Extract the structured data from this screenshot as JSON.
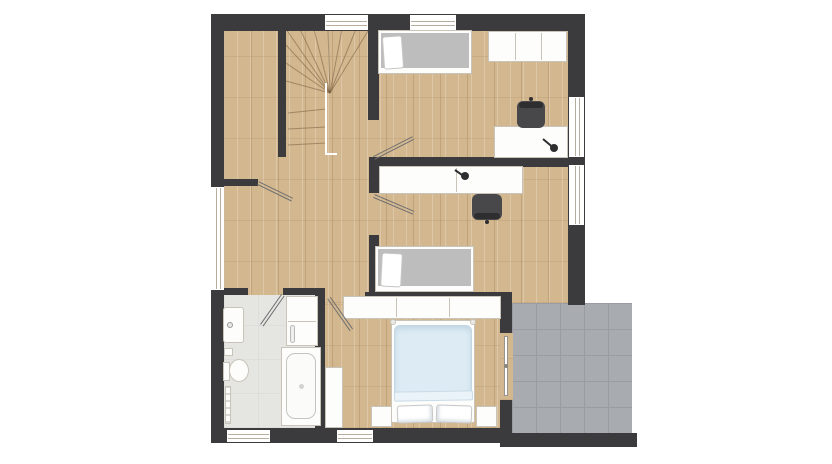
{
  "plan": {
    "kind": "residential-floor-plan",
    "visible_text": "",
    "rooms": [
      {
        "id": "closet",
        "name": "closet",
        "floor": "wood",
        "furniture": []
      },
      {
        "id": "stairwell",
        "name": "stairwell",
        "floor": "wood",
        "furniture": [
          "winder-stairs",
          "railing"
        ]
      },
      {
        "id": "hallway",
        "name": "hallway",
        "floor": "wood",
        "furniture": []
      },
      {
        "id": "bedroom-1",
        "name": "bedroom-top-right",
        "floor": "wood",
        "furniture": [
          "single-bed",
          "wardrobe",
          "desk",
          "office-chair",
          "desk-lamp"
        ]
      },
      {
        "id": "bedroom-2",
        "name": "bedroom-middle-right",
        "floor": "wood",
        "furniture": [
          "single-bed",
          "desk",
          "office-chair",
          "desk-lamp"
        ]
      },
      {
        "id": "bathroom",
        "name": "bathroom",
        "floor": "tile-light",
        "furniture": [
          "sink",
          "toilet",
          "towel-radiator",
          "bathtub",
          "bath-cabinet"
        ]
      },
      {
        "id": "bedroom-master",
        "name": "bedroom-master",
        "floor": "wood",
        "furniture": [
          "double-bed",
          "wardrobe",
          "nightstand-left",
          "nightstand-right",
          "tall-cabinet"
        ]
      },
      {
        "id": "terrace",
        "name": "terrace",
        "floor": "tile-grey",
        "furniture": []
      }
    ],
    "openings": {
      "windows": [
        "top-wall-1",
        "top-wall-2",
        "left-wall-1",
        "right-wall-1",
        "right-wall-2",
        "bottom-wall-1",
        "bottom-wall-2"
      ],
      "doors": [
        "closet-door",
        "bedroom-1-door",
        "bedroom-2-door",
        "bathroom-door",
        "master-door",
        "terrace-glass-door"
      ]
    }
  },
  "colors": {
    "bg": "#ffffff",
    "wall": "#3b3b3d",
    "wood": "#d3b78f",
    "bath": "#e5e5e1",
    "tile": "#a8acb1",
    "tileline": "#999da3",
    "furn": "#fdfdfc",
    "furnline": "#c9c4b9",
    "mattress": "#bdbdbd",
    "duvet": "#dcebf4",
    "duvetfold": "#eaf3f8",
    "chair": "#48484b",
    "black": "#2e2e30",
    "doorline": "#6f6f6f",
    "glass": "#b6ad9e"
  }
}
